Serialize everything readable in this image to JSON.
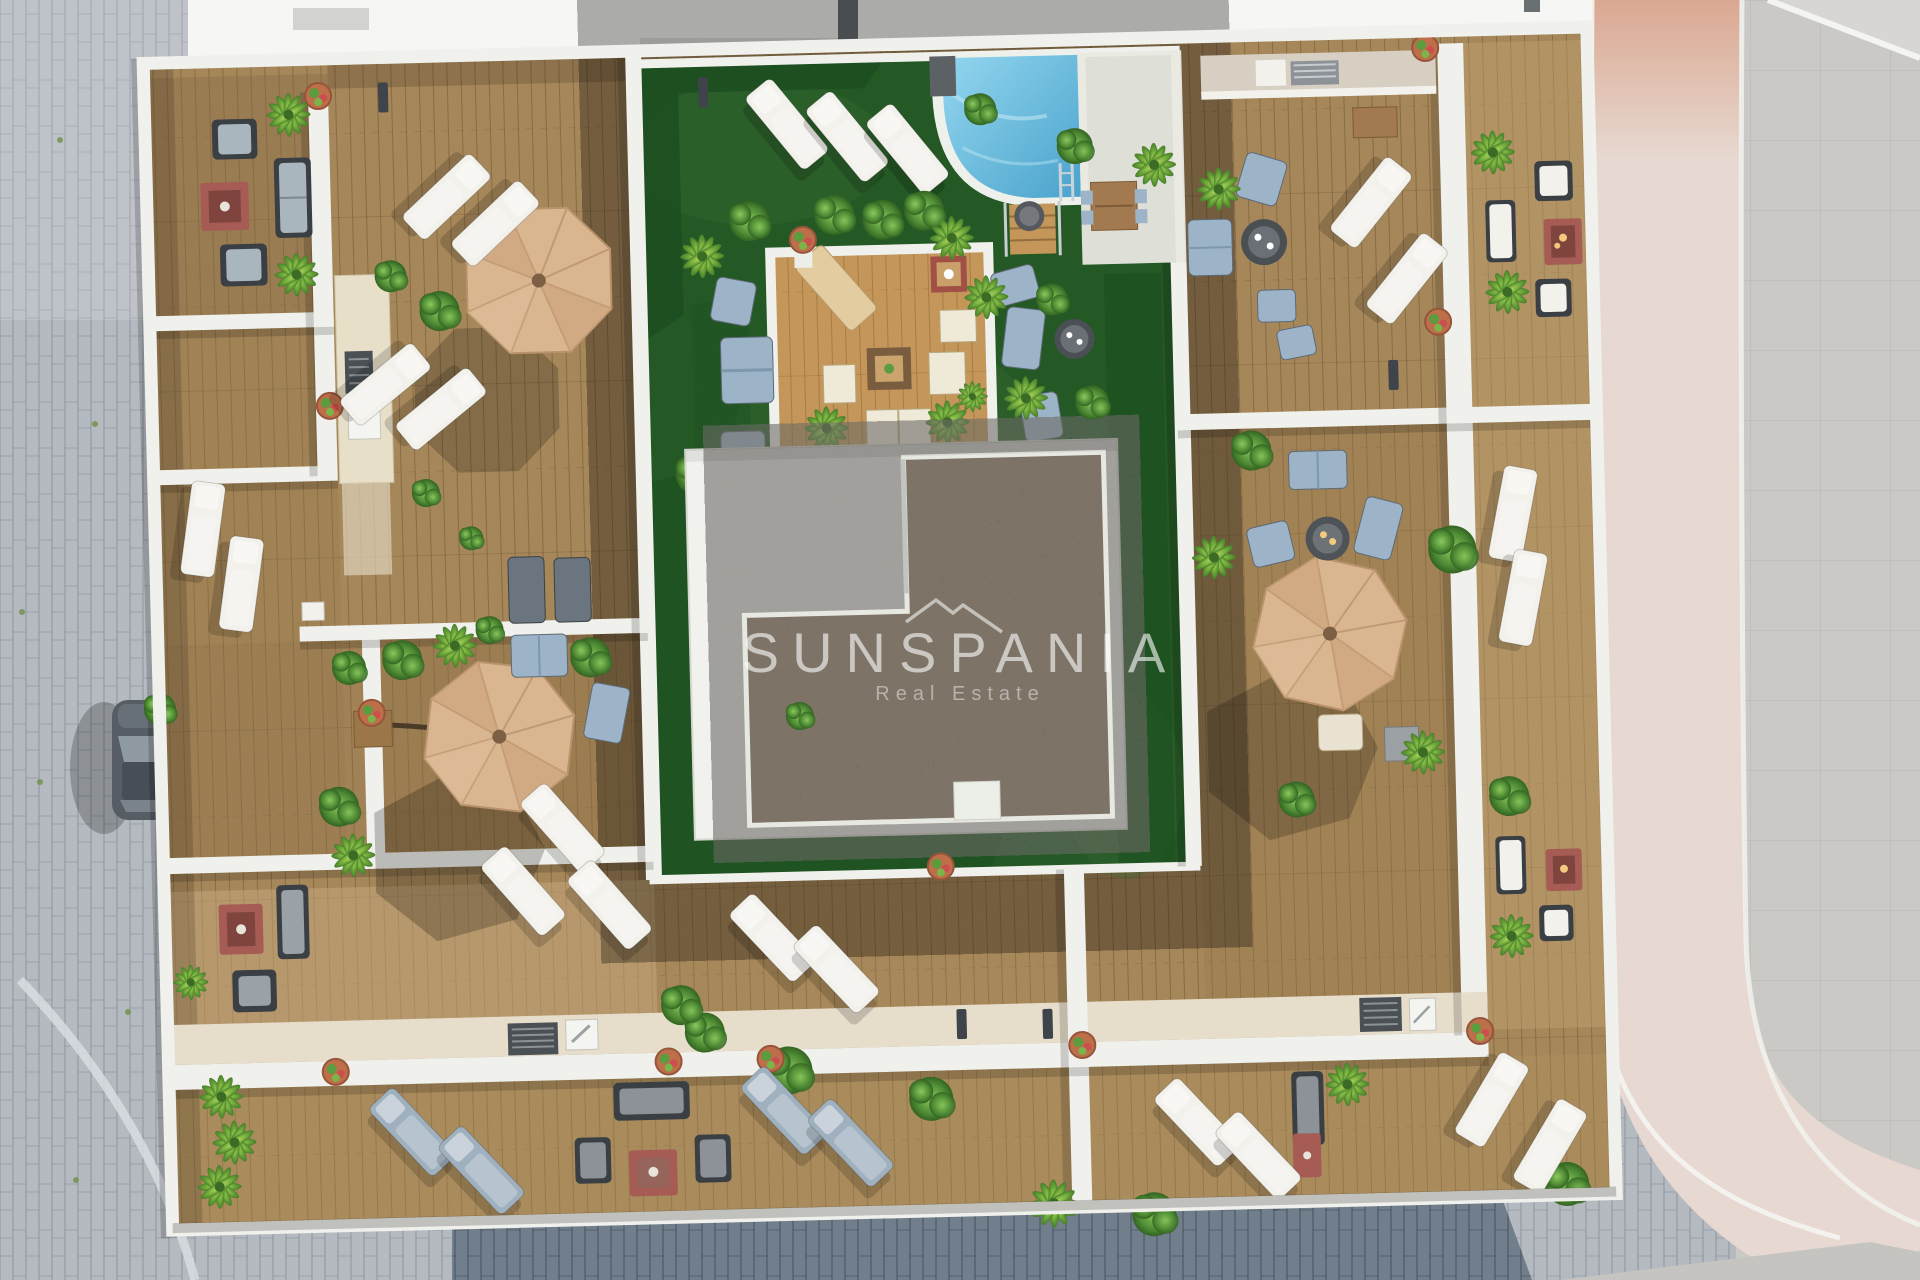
{
  "watermark": {
    "brand": "SUNSPANIA",
    "tagline": "Real Estate"
  },
  "palette": {
    "pavement": "#b5bac0",
    "pavement_dark": "#717e8b",
    "road": "#e7d9d1",
    "road_warm": "#d89f86",
    "sidewalk": "#cbc9c6",
    "building": "#f6f7f4",
    "wall": "#f0f1ec",
    "wood": "#a6875a",
    "wood_light": "#c5a77c",
    "wood_dark": "#7a6342",
    "pergola_wood": "#c49659",
    "grass": "#357f36",
    "grass_dark": "#1c4e20",
    "grass_light": "#4f9a48",
    "pool_light": "#93d6ef",
    "pool_deep": "#4aa3cc",
    "gravel": "#97806a",
    "umbrella": "#d9b590",
    "umbrella_alt": "#cda47c",
    "furniture_white": "#f2f1ec",
    "furniture_blue": "#9db3c8",
    "furniture_gray": "#8d9298",
    "table_red": "#a65b54",
    "plant_green": "#5a9c3e",
    "pot_terracotta": "#bd6f4a",
    "car_gray": "#565d64"
  }
}
